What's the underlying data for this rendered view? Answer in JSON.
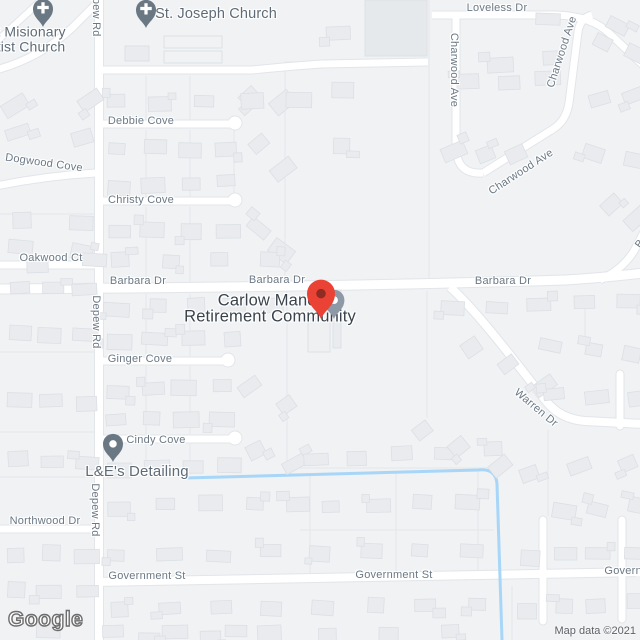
{
  "map": {
    "google_logo": "Google",
    "attribution": "Map data ©2021",
    "colors": {
      "land": "#f0f2f4",
      "road_fill": "#ffffff",
      "road_casing": "#e2e5e9",
      "parcel_line": "#e4e7eb",
      "building_fill": "#e9ebee",
      "building_stroke": "#dcdfe4",
      "special_building_fill": "#e6e9ec",
      "water": "#a8d6f8",
      "street_label": "#6b7885",
      "poi_label": "#5f6b76",
      "place_label": "#3a434c",
      "pin_red": "#ea4335",
      "pin_red_inner": "#8f2b22",
      "pin_gray": "#8d99a6",
      "pin_slate": "#6a7884"
    },
    "street_labels": [
      {
        "name": "street-label-loveless-dr",
        "text": "Loveless Dr",
        "x": 497,
        "y": 8,
        "rot": 0
      },
      {
        "name": "street-label-charwood-ave-1",
        "text": "Charwood Ave",
        "x": 454,
        "y": 70,
        "rot": 90
      },
      {
        "name": "street-label-charwood-ave-2",
        "text": "Charwood Ave",
        "x": 562,
        "y": 52,
        "rot": -72
      },
      {
        "name": "street-label-charwood-ave-3",
        "text": "Charwood Ave",
        "x": 521,
        "y": 172,
        "rot": -33
      },
      {
        "name": "street-label-debbie-cove",
        "text": "Debbie Cove",
        "x": 141,
        "y": 121,
        "rot": 0
      },
      {
        "name": "street-label-dogwood-cove",
        "text": "Dogwood Cove",
        "x": 44,
        "y": 163,
        "rot": 8
      },
      {
        "name": "street-label-christy-cove",
        "text": "Christy Cove",
        "x": 141,
        "y": 200,
        "rot": 0
      },
      {
        "name": "street-label-oakwood-ct",
        "text": "Oakwood Ct",
        "x": 51,
        "y": 258,
        "rot": 0
      },
      {
        "name": "street-label-depew-rd-1",
        "text": "Depew Rd",
        "x": 96,
        "y": 10,
        "rot": 90
      },
      {
        "name": "street-label-depew-rd-2",
        "text": "Depew Rd",
        "x": 96,
        "y": 322,
        "rot": 90
      },
      {
        "name": "street-label-depew-rd-3",
        "text": "Depew Rd",
        "x": 95,
        "y": 510,
        "rot": 90
      },
      {
        "name": "street-label-barbara-dr-1",
        "text": "Barbara Dr",
        "x": 138,
        "y": 281,
        "rot": 0
      },
      {
        "name": "street-label-barbara-dr-2",
        "text": "Barbara Dr",
        "x": 277,
        "y": 280,
        "rot": 0
      },
      {
        "name": "street-label-barbara-dr-3",
        "text": "Barbara Dr",
        "x": 503,
        "y": 281,
        "rot": 0
      },
      {
        "name": "street-label-barbara-dr-4",
        "text": "Barbara Dr",
        "x": 654,
        "y": 224,
        "rot": -55
      },
      {
        "name": "street-label-ginger-cove",
        "text": "Ginger Cove",
        "x": 140,
        "y": 359,
        "rot": 0
      },
      {
        "name": "street-label-warren-dr",
        "text": "Warren Dr",
        "x": 536,
        "y": 408,
        "rot": 40
      },
      {
        "name": "street-label-cindy-cove",
        "text": "Cindy Cove",
        "x": 156,
        "y": 440,
        "rot": 0
      },
      {
        "name": "street-label-northwood-dr",
        "text": "Northwood Dr",
        "x": 45,
        "y": 521,
        "rot": 0
      },
      {
        "name": "street-label-government-st-1",
        "text": "Government St",
        "x": 147,
        "y": 576,
        "rot": 0
      },
      {
        "name": "street-label-government-st-2",
        "text": "Government St",
        "x": 394,
        "y": 575,
        "rot": 0
      },
      {
        "name": "street-label-government-st-3",
        "text": "Government St",
        "x": 643,
        "y": 571,
        "rot": 0
      }
    ],
    "poi_labels": [
      {
        "name": "poi-label-baptist-church",
        "lines": [
          "t Misionary",
          "tist Church"
        ],
        "x": 31,
        "y": 39,
        "size": 14,
        "kind": "poi"
      },
      {
        "name": "poi-label-st-joseph-church",
        "lines": [
          "St. Joseph Church"
        ],
        "x": 216,
        "y": 14,
        "size": 14.5,
        "kind": "poi"
      },
      {
        "name": "poi-label-carlow-manor",
        "lines": [
          "Carlow Manor",
          "Retirement Community"
        ],
        "x": 270,
        "y": 309,
        "size": 16.5,
        "kind": "place"
      },
      {
        "name": "poi-label-le-detailing",
        "lines": [
          "L&E's Detailing"
        ],
        "x": 137,
        "y": 472,
        "size": 15,
        "kind": "poi"
      }
    ],
    "markers": [
      {
        "name": "st-joseph-church-pin",
        "type": "church",
        "x": 146,
        "y": 28,
        "scale": 1.25
      },
      {
        "name": "baptist-church-pin",
        "type": "church",
        "x": 43,
        "y": 27,
        "scale": 1.25
      },
      {
        "name": "le-detailing-pin",
        "type": "dot",
        "x": 113,
        "y": 462,
        "scale": 1.25
      },
      {
        "name": "carlow-manor-gray-pin",
        "type": "gray",
        "x": 334,
        "y": 319,
        "scale": 1.3
      },
      {
        "name": "carlow-manor-red-pin",
        "type": "red",
        "x": 321,
        "y": 319,
        "scale": 1.75
      }
    ]
  }
}
